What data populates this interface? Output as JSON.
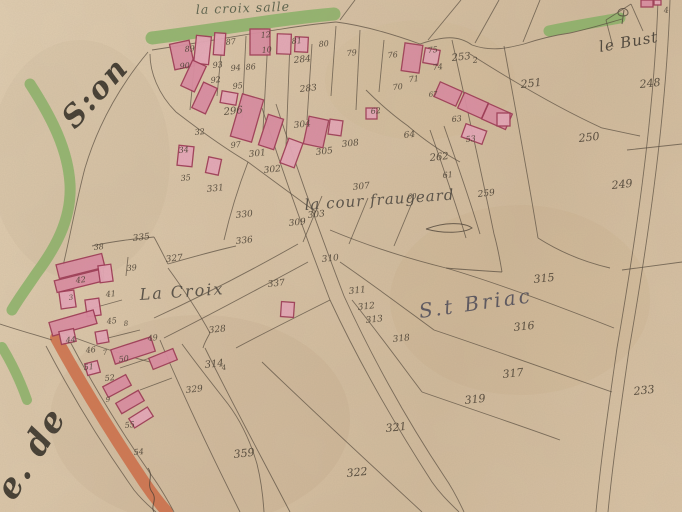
{
  "map": {
    "region_label": "S.t Briac",
    "colors": {
      "green": "#7fb25f",
      "orange": "#cf6038",
      "ink": "#3c332a",
      "line": "#4e4336",
      "bfill": "#e8a7ba",
      "bdark": "#dd8ba3",
      "bstroke": "#9d3252",
      "label": "#474335",
      "briac": "#4d4b58"
    },
    "labels": [
      {
        "id": "la-croix-salle",
        "text": "la croix salle",
        "x": 196,
        "y": 14,
        "size": 12.5,
        "rot": -2,
        "ls": 1,
        "color": "#4a5540"
      },
      {
        "id": "le-bust",
        "text": "le Bust",
        "x": 600,
        "y": 52,
        "size": 15,
        "rot": -10,
        "ls": 1,
        "color": "#3a342c"
      },
      {
        "id": "la-cour-fraugeard",
        "text": "la cour fraugeard",
        "x": 305,
        "y": 210,
        "size": 15,
        "rot": -4,
        "ls": 1,
        "color": "#46413a"
      },
      {
        "id": "la-croix",
        "text": "La Croix",
        "x": 140,
        "y": 300,
        "size": 16,
        "rot": -4,
        "ls": 2,
        "color": "#46413a"
      },
      {
        "id": "st-briac",
        "text": "S.t Briac",
        "x": 420,
        "y": 318,
        "size": 20,
        "rot": -8,
        "ls": 3,
        "color": "#4d4b58"
      },
      {
        "id": "margin-script-son",
        "text": "S:on",
        "x": 75,
        "y": 130,
        "size": 30,
        "rot": -48,
        "ls": 2,
        "color": "#2f2a22",
        "w": "bold"
      },
      {
        "id": "margin-script-de",
        "text": "e. de",
        "x": 14,
        "y": 502,
        "size": 34,
        "rot": -58,
        "ls": 2,
        "color": "#2f2a22",
        "w": "bold"
      }
    ],
    "numbers": [
      [
        "89",
        185,
        52,
        8
      ],
      [
        "90",
        180,
        69,
        8
      ],
      [
        "93",
        213,
        68,
        8
      ],
      [
        "92",
        211,
        83,
        8
      ],
      [
        "94",
        231,
        71,
        8
      ],
      [
        "95",
        233,
        89,
        8
      ],
      [
        "87",
        226,
        45,
        8
      ],
      [
        "12",
        261,
        38,
        8
      ],
      [
        "10",
        262,
        53,
        8
      ],
      [
        "86",
        246,
        70,
        8
      ],
      [
        "81",
        292,
        44,
        8
      ],
      [
        "80",
        319,
        47,
        8
      ],
      [
        "79",
        347,
        56,
        8
      ],
      [
        "76",
        388,
        58,
        8
      ],
      [
        "75",
        428,
        53,
        8
      ],
      [
        "74",
        433,
        70,
        8
      ],
      [
        "71",
        409,
        82,
        8
      ],
      [
        "70",
        393,
        90,
        8
      ],
      [
        "67",
        429,
        97,
        7
      ],
      [
        "62",
        371,
        114,
        8
      ],
      [
        "64",
        404,
        138
      ],
      [
        "63",
        452,
        122,
        8
      ],
      [
        "53",
        466,
        142,
        8
      ],
      [
        "61",
        443,
        178,
        8
      ],
      [
        "253",
        452,
        61,
        10
      ],
      [
        "2",
        473,
        63,
        8
      ],
      [
        "251",
        521,
        88,
        11
      ],
      [
        "248",
        640,
        88,
        11
      ],
      [
        "4",
        664,
        13,
        8
      ],
      [
        "284",
        294,
        63
      ],
      [
        "283",
        300,
        92
      ],
      [
        "296",
        224,
        115,
        10
      ],
      [
        "250",
        579,
        142,
        11
      ],
      [
        "249",
        612,
        189,
        11
      ],
      [
        "262",
        430,
        161,
        10
      ],
      [
        "259",
        478,
        197
      ],
      [
        "60",
        408,
        199,
        7
      ],
      [
        "307",
        353,
        190
      ],
      [
        "303",
        308,
        218
      ],
      [
        "97",
        231,
        148,
        8
      ],
      [
        "301",
        249,
        157
      ],
      [
        "304",
        294,
        128
      ],
      [
        "305",
        316,
        155
      ],
      [
        "302",
        264,
        173
      ],
      [
        "308",
        342,
        147
      ],
      [
        "34",
        179,
        153,
        8
      ],
      [
        "35",
        181,
        181,
        8
      ],
      [
        "32",
        195,
        135,
        8
      ],
      [
        "331",
        207,
        192
      ],
      [
        "330",
        236,
        218
      ],
      [
        "336",
        236,
        244
      ],
      [
        "335",
        133,
        241
      ],
      [
        "327",
        166,
        262
      ],
      [
        "337",
        268,
        287
      ],
      [
        "309",
        289,
        226
      ],
      [
        "310",
        322,
        262
      ],
      [
        "311",
        349,
        294
      ],
      [
        "312",
        358,
        310
      ],
      [
        "313",
        366,
        323
      ],
      [
        "315",
        534,
        283,
        11
      ],
      [
        "316",
        514,
        331,
        11
      ],
      [
        "317",
        503,
        378,
        11
      ],
      [
        "319",
        465,
        404,
        11
      ],
      [
        "318",
        393,
        342
      ],
      [
        "233",
        634,
        395,
        11
      ],
      [
        "321",
        386,
        432,
        11
      ],
      [
        "322",
        347,
        477,
        11
      ],
      [
        "359",
        234,
        458,
        11
      ],
      [
        "314",
        205,
        368,
        10
      ],
      [
        "4",
        222,
        370,
        7
      ],
      [
        "329",
        186,
        393
      ],
      [
        "328",
        209,
        333
      ],
      [
        "38",
        94,
        250,
        8
      ],
      [
        "39",
        127,
        271,
        8
      ],
      [
        "42",
        76,
        283,
        8
      ],
      [
        "41",
        106,
        297,
        8
      ],
      [
        "3",
        69,
        300,
        7
      ],
      [
        "45",
        107,
        324,
        8
      ],
      [
        "8",
        124,
        326,
        7
      ],
      [
        "44",
        66,
        343,
        8
      ],
      [
        "49",
        148,
        341,
        8
      ],
      [
        "46",
        86,
        353,
        8
      ],
      [
        "7",
        103,
        355,
        7
      ],
      [
        "50",
        119,
        362,
        8
      ],
      [
        "51",
        84,
        370,
        8
      ],
      [
        "52",
        105,
        381,
        8
      ],
      [
        "9",
        106,
        402,
        7
      ],
      [
        "55",
        125,
        428,
        8
      ],
      [
        "54",
        134,
        455,
        8
      ]
    ],
    "roads": [
      [
        "green",
        13,
        "M152,38 C215,30 285,18 334,14"
      ],
      [
        "green",
        11,
        "M549,31 C572,26 598,22 620,18"
      ],
      [
        "green",
        11,
        "M30,84 C52,118 68,150 70,184 C72,220 54,250 36,274 C28,286 19,298 12,310"
      ],
      [
        "green",
        10,
        "M2,347 C11,362 20,380 27,400"
      ],
      [
        "orange",
        12,
        "M56,338 C80,382 112,434 144,482 C152,494 160,504 167,512"
      ]
    ],
    "boundaries": [
      "M152,50 C218,40 290,26 336,22",
      "M336,22 C368,26 398,36 420,44",
      "M420,44 C444,36 458,35 472,45",
      "M472,45 C492,52 508,48 524,44",
      "M524,44 C542,38 556,35 570,33",
      "M570,33 C592,28 608,23 622,19",
      "M340,20 L355,0",
      "M428,40 L461,0",
      "M475,43 L499,0",
      "M523,42 L540,0",
      "M606,20 L631,4",
      "M631,4 L643,31",
      "M606,20 L613,47",
      "M148,52 C118,88 97,128 85,168 C77,198 71,232 63,266",
      "M176,112 C158,94 150,72 150,54",
      "M176,112 C202,132 224,148 248,162",
      "M248,162 C272,180 294,196 316,212",
      "M248,162 C238,188 230,214 224,240",
      "M262,108 C282,170 304,232 330,300",
      "M330,300 C356,356 392,420 432,482 C441,495 451,504 459,512",
      "M276,104 C296,166 318,228 344,296",
      "M344,296 C369,351 404,416 444,476 C451,486 458,499 464,512",
      "M298,244 C252,270 202,296 154,318",
      "M308,262 C260,288 212,314 164,338",
      "M452,40 C466,104 481,170 494,234",
      "M504,46 C516,112 528,176 538,238",
      "M470,54 C514,82 558,108 602,128 L640,136",
      "M430,130 C444,170 456,204 466,238",
      "M444,126 C458,166 470,200 480,234",
      "M538,238 C560,252 584,262 610,268",
      "M446,268 C494,282 548,302 614,328",
      "M434,330 C482,346 532,364 612,392",
      "M422,392 C468,408 516,424 560,440",
      "M330,230 C368,246 406,258 446,268",
      "M340,262 C372,284 404,308 434,330",
      "M352,300 C376,330 398,360 422,392",
      "M322,196 L303,242",
      "M368,198 L349,244",
      "M414,198 L394,246",
      "M160,340 C184,398 212,456 240,512",
      "M205,348 C232,403 262,458 290,512",
      "M236,348 C266,332 298,316 330,300",
      "M262,362 C316,414 368,462 422,512",
      "M182,344 C198,366 214,386 228,404 C240,420 250,440 257,464 C261,480 263,496 264,512",
      "M658,0 C654,120 634,250 617,348 C609,404 601,458 596,512",
      "M670,0 C666,122 646,252 629,350 C621,406 613,460 608,512",
      "M622,270 L682,262",
      "M627,150 L682,144",
      "M92,246 C114,241 134,239 154,237",
      "M154,237 C160,248 164,256 168,264",
      "M168,264 C196,256 218,250 236,246",
      "M168,268 C184,290 198,311 210,333",
      "M210,333 C206,340 204,344 203,348",
      "M0,324 C18,330 36,335 52,340",
      "M46,346 C70,392 100,442 134,490 C142,500 150,507 156,512",
      "M66,334 C90,380 120,430 152,476 C160,487 167,499 174,512",
      "M60,332 C90,344 120,354 150,362",
      "M196,48 L190,110",
      "M222,44 L217,96",
      "M246,36 L242,118",
      "M268,38 L263,130",
      "M290,42 L286,146",
      "M312,44 L307,120",
      "M336,26 L331,96",
      "M360,30 L356,110",
      "M384,40 L379,92",
      "M104,262 L103,282",
      "M128,257 L126,276",
      "M86,310 L122,300",
      "M100,340 L140,330",
      "M120,368 L156,356",
      "M140,390 L172,378",
      "M366,90 C380,104 394,116 408,126",
      "M408,126 C424,140 442,152 460,162",
      "M494,234 C498,248 500,260 502,272",
      "M502,272 C470,270 456,269 446,268"
    ],
    "buildings": [
      [
        172,
        42,
        20,
        26,
        -12,
        1
      ],
      [
        195,
        36,
        15,
        28,
        6,
        0
      ],
      [
        214,
        33,
        11,
        22,
        4,
        0
      ],
      [
        250,
        29,
        20,
        26,
        0,
        1
      ],
      [
        277,
        34,
        14,
        20,
        2,
        0
      ],
      [
        295,
        37,
        13,
        15,
        3,
        0
      ],
      [
        186,
        62,
        15,
        28,
        25,
        1
      ],
      [
        197,
        84,
        15,
        28,
        25,
        1
      ],
      [
        221,
        92,
        16,
        12,
        10,
        0
      ],
      [
        236,
        96,
        22,
        44,
        16,
        1
      ],
      [
        263,
        116,
        16,
        32,
        18,
        1
      ],
      [
        284,
        140,
        15,
        26,
        20,
        0
      ],
      [
        306,
        118,
        20,
        28,
        12,
        1
      ],
      [
        178,
        146,
        15,
        20,
        6,
        0
      ],
      [
        207,
        158,
        13,
        16,
        12,
        0
      ],
      [
        329,
        120,
        13,
        15,
        8,
        0
      ],
      [
        366,
        108,
        11,
        11,
        0,
        0
      ],
      [
        403,
        44,
        18,
        28,
        8,
        1
      ],
      [
        424,
        49,
        15,
        15,
        10,
        0
      ],
      [
        436,
        86,
        24,
        16,
        24,
        1
      ],
      [
        460,
        97,
        26,
        17,
        24,
        1
      ],
      [
        484,
        108,
        26,
        17,
        24,
        1
      ],
      [
        463,
        127,
        22,
        14,
        20,
        0
      ],
      [
        497,
        113,
        13,
        13,
        0,
        0
      ],
      [
        57,
        259,
        47,
        14,
        -14,
        1
      ],
      [
        55,
        275,
        47,
        12,
        -14,
        1
      ],
      [
        99,
        265,
        13,
        17,
        -8,
        0
      ],
      [
        60,
        291,
        15,
        17,
        -8,
        0
      ],
      [
        86,
        299,
        14,
        17,
        -8,
        0
      ],
      [
        50,
        316,
        46,
        14,
        -16,
        1
      ],
      [
        60,
        330,
        15,
        13,
        -12,
        0
      ],
      [
        96,
        331,
        12,
        12,
        -10,
        0
      ],
      [
        112,
        343,
        42,
        15,
        -18,
        1
      ],
      [
        150,
        353,
        26,
        12,
        -22,
        1
      ],
      [
        86,
        362,
        13,
        12,
        -15,
        0
      ],
      [
        104,
        380,
        26,
        12,
        -28,
        1
      ],
      [
        117,
        396,
        26,
        12,
        -30,
        1
      ],
      [
        130,
        412,
        22,
        11,
        -32,
        0
      ],
      [
        281,
        302,
        13,
        15,
        4,
        0
      ],
      [
        641,
        0,
        12,
        7,
        0,
        1
      ],
      [
        654,
        0,
        7,
        5,
        0,
        0
      ]
    ],
    "flourishes": [
      "M426,229 C444,222 464,222 472,228 C464,233 444,234 426,229",
      "M148,468 C154,476 146,484 152,492 C158,500 150,506 154,512",
      "M622,24 L624,10 M618,13 C618,7 628,7 628,13 C628,17 618,17 618,13"
    ],
    "stains": [
      [
        520,
        300,
        130,
        95,
        "rgba(150,110,60,0.05)"
      ],
      [
        200,
        420,
        150,
        105,
        "rgba(140,100,60,0.06)"
      ],
      [
        420,
        80,
        95,
        60,
        "rgba(205,165,115,0.07)"
      ],
      [
        80,
        160,
        90,
        120,
        "rgba(135,110,70,0.05)"
      ]
    ]
  }
}
